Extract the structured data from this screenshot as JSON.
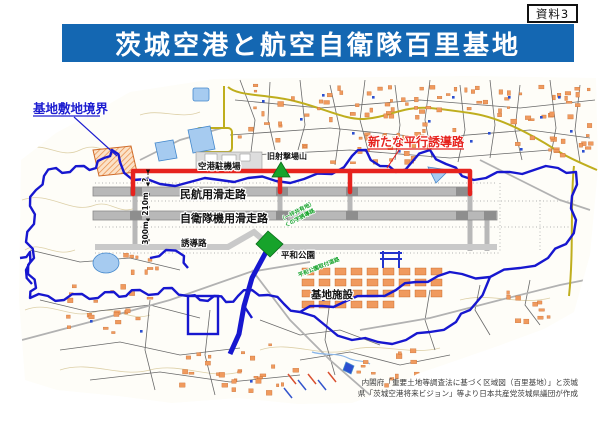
{
  "page": {
    "doc_label": "資料3",
    "title": "茨城空港と航空自衛隊百里基地"
  },
  "map": {
    "labels": {
      "base_boundary": "基地敷地境界",
      "new_taxiway": "新たな平行誘導路",
      "apron": "空港駐機場",
      "old_range": "旧射撃場山",
      "civil_runway": "民航用滑走路",
      "jsdf_runway": "自衛隊機用滑走路",
      "taxiway": "誘導路",
      "peace_park": "平和公園",
      "base_facilities": "基地施設",
      "green_note1_line1": "（一坪共有地）",
      "green_note1_line2": "くの字誘導路",
      "green_note2": "平和公園取付道路"
    },
    "measurements": {
      "new_taxiway_gap": "?",
      "runway_gap": "210m",
      "taxiway_gap": "300m"
    },
    "credit": {
      "line1": "内閣府「重要土地等調査法に基づく区域図（百里基地）」と茨城",
      "line2": "県「茨城空港将来ビジョン」等より日本共産党茨城県議団が作成"
    }
  },
  "colors": {
    "banner_bg": "#1467b2",
    "banner_text": "#ffffff",
    "boundary_blue": "#1717cf",
    "label_blue": "#1d1dd0",
    "accent_red": "#e6231e",
    "runway_gray": "#b8b8b8",
    "runway_dark": "#8e8e8e",
    "taxiway_gray": "#c9c9c9",
    "site_green": "#17a32b",
    "building_orange": "#f09a5e",
    "road_yellow": "#bfae1e",
    "water_blue": "#a6cbf0",
    "credit_gray": "#3a3a3a"
  }
}
